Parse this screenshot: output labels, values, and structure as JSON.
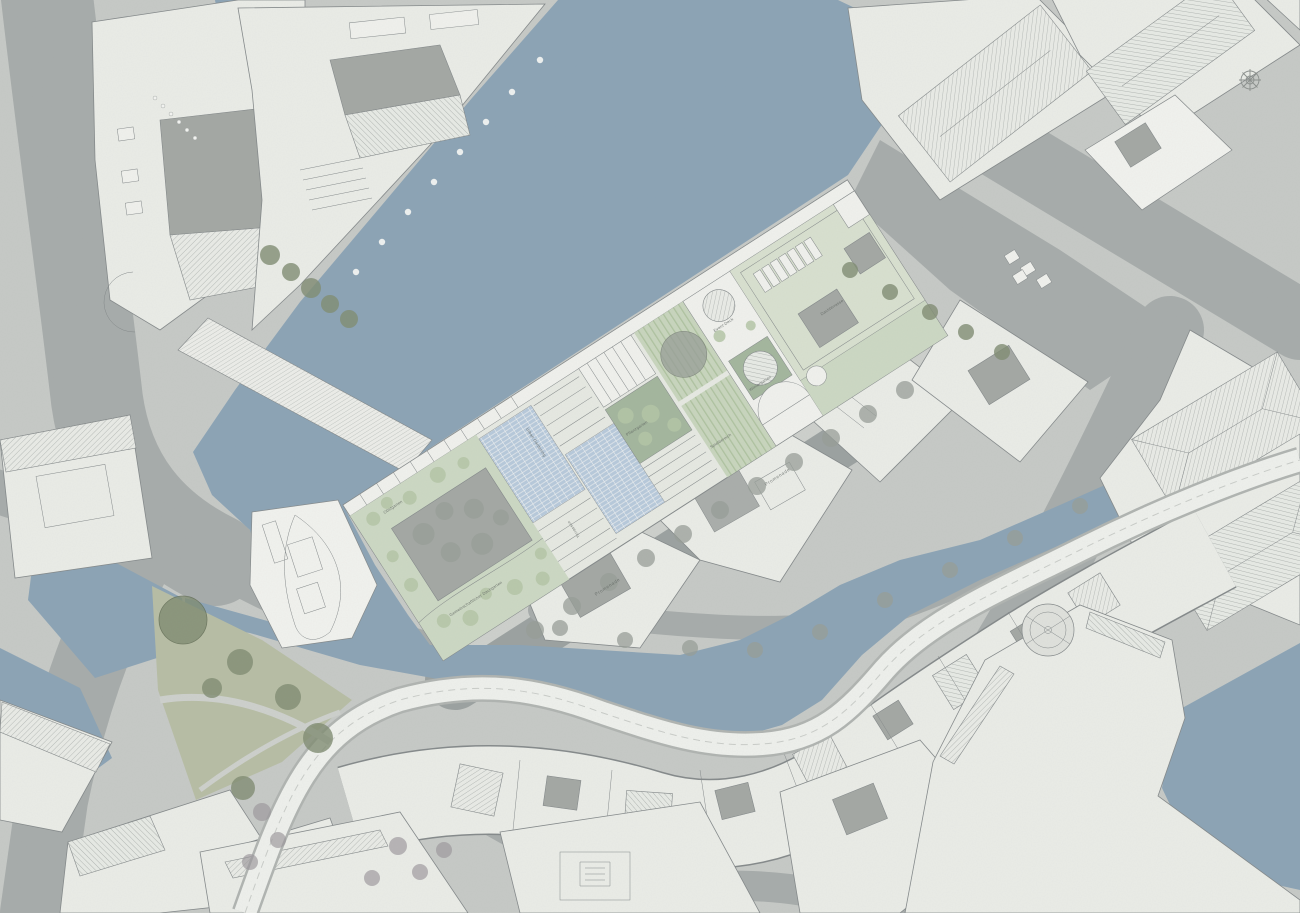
{
  "meta": {
    "drawing_type": "architectural masterplan / roof plan with canals",
    "orientation_note": "central design site rotated, flanked by canal and promenade"
  },
  "colors": {
    "paper": "#c6c9c6",
    "road": "#a6abaa",
    "road-dark": "#9ba1a0",
    "walk-light": "#cdd0cc",
    "water": "#8ba3b5",
    "building": "#eaece7",
    "building-bright": "#f1f2ee",
    "building-line": "#84898a",
    "roof-dark": "#a9adaa",
    "court": "#a3a7a3",
    "hatch-line": "#a2a7a4",
    "site-base": "#e6e9e2",
    "site-green": "#ccd8c3",
    "site-green-pale": "#d8e0cf",
    "green-dark": "#a3b69d",
    "lawn-a": "#aec29f",
    "lawn-b": "#c8d5bd",
    "pv-blue": "#b7c9db",
    "tree-gray": "#979d97",
    "tree-olive": "#7f8c72",
    "tree-purple": "#9a9599",
    "bush": "#b4c6a6",
    "park": "#b7bda4",
    "white": "#f0f1ed",
    "label": "#5d635f"
  },
  "site": {
    "name": "central-roof-garden-site",
    "labels": [
      {
        "text": "Gemeinschaftlicher Dachgarten"
      },
      {
        "text": "Terrassen"
      },
      {
        "text": "Urban Gardening"
      },
      {
        "text": "Pflanzgarten"
      },
      {
        "text": "Spielbereich"
      },
      {
        "text": "Wintergarten"
      },
      {
        "text": "Event-Deck"
      },
      {
        "text": "Dachterrasse"
      },
      {
        "text": "Obstgarten"
      }
    ]
  },
  "streets": {
    "labels": [
      {
        "text": "Promenade"
      },
      {
        "text": "Promenade"
      }
    ]
  },
  "icons": {
    "north_arrow": "compass-rose"
  }
}
